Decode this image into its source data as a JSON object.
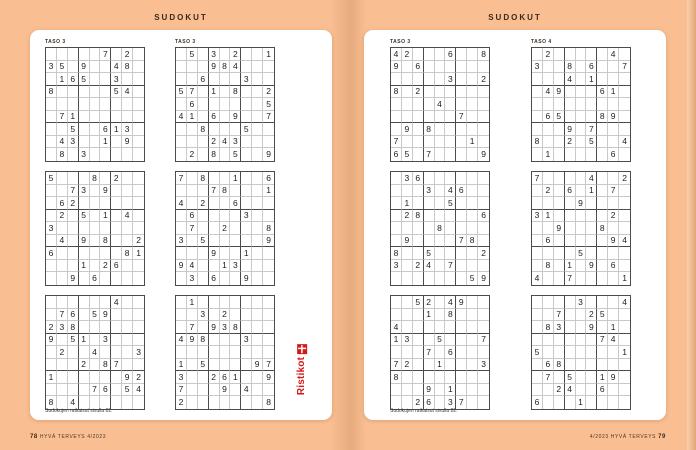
{
  "header": {
    "title": "SUDOKUT"
  },
  "pages": [
    {
      "side": "left",
      "note": "Sudokujen ratkaisut sivulla 82.",
      "logo_text": "Ristikot",
      "grids": [
        {
          "label": "TASO 3",
          "rows": [
            ".....7.2.",
            "35.9..48.",
            ".165..3..",
            "8.....54.",
            ".........",
            ".71......",
            "..5..613.",
            ".43..1.9.",
            ".8.3....."
          ]
        },
        {
          "label": "TASO 3",
          "rows": [
            ".5.3.2..1",
            "...984...",
            "..6...3..",
            "57.1.8..2",
            ".6......5",
            "41.6.9..7",
            "..8...5..",
            "...243...",
            ".2.8.5..9"
          ]
        },
        {
          "label": "",
          "rows": [
            "5...8.2..",
            "..73.9...",
            ".62......",
            ".2.5.1.4.",
            "3........",
            ".4.9.8..2",
            "6......81",
            "...1.26..",
            "..9.6...."
          ]
        },
        {
          "label": "",
          "rows": [
            "7.8..1..6",
            "...78...1",
            "4.2..6...",
            ".6....3..",
            ".7..2...8",
            "3.5.....9",
            "...9..1..",
            "94..13...",
            ".3.6..9.."
          ]
        },
        {
          "label": "",
          "rows": [
            "......4..",
            ".76.59...",
            "238......",
            "9.51.3...",
            ".2..4...3",
            "...2.87..",
            "1......92",
            "....76.54",
            "8.4......"
          ]
        },
        {
          "label": "",
          "rows": [
            ".1.......",
            "..3.2....",
            ".7.938...",
            "498...3..",
            ".........",
            "1.5....97",
            "3..261..9",
            "7...9.4..",
            "2.......8"
          ]
        }
      ]
    },
    {
      "side": "right",
      "note": "Sudokujen ratkaisut sivulla 82.",
      "grids": [
        {
          "label": "TASO 3",
          "rows": [
            "42...6..8",
            "9.6......",
            ".....3..2",
            "8.2......",
            "....4....",
            "......7..",
            ".9.8.....",
            "7......1.",
            "65.7....9"
          ]
        },
        {
          "label": "TASO 4",
          "rows": [
            ".2.....4.",
            "3..8.6..7",
            "...4.1...",
            ".49...61.",
            ".........",
            ".65...89.",
            "...9.7...",
            "8..2.5..4",
            ".1.....6."
          ]
        },
        {
          "label": "",
          "rows": [
            ".36......",
            "...3.46..",
            ".1...5...",
            ".28.....6",
            "....8....",
            ".9....78.",
            "8..5....2",
            "3.24.7...",
            ".......59"
          ]
        },
        {
          "label": "",
          "rows": [
            "7....4..2",
            ".2.6.1.7.",
            "....9....",
            "31.....2.",
            "..9...8..",
            ".6.....94",
            "....5....",
            ".8.1.9.6.",
            "4..7....1"
          ]
        },
        {
          "label": "",
          "rows": [
            "..52.49..",
            "...1.8...",
            "4........",
            "13..5...7",
            "...7.6...",
            "72..1...3",
            "8........",
            "...9.1...",
            "..26.37.."
          ]
        },
        {
          "label": "",
          "rows": [
            "....3...4",
            "..7..25..",
            ".83..9.1.",
            "......74.",
            "5.......1",
            ".68......",
            ".7.5..19.",
            "..24..6..",
            "6...1...."
          ]
        }
      ]
    }
  ],
  "footer": {
    "left_page_number": "78",
    "left_text": "HYVÄ TERVEYS 4/2023",
    "right_text": "4/2023 HYVÄ TERVEYS",
    "right_page_number": "79"
  },
  "colors": {
    "background": "#f9bf92",
    "page": "#ffffff",
    "grid_line": "#c9c9c9",
    "grid_line_bold": "#4b4b4b",
    "digit": "#222222",
    "header_text": "#3a2a1c",
    "logo_red": "#d41a18"
  }
}
